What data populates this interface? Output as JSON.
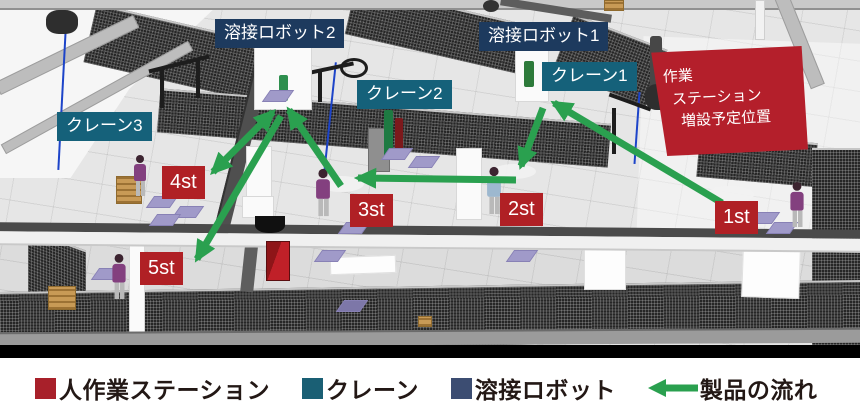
{
  "figure": {
    "title_hint": "3D factory layout simulation with product flow",
    "annotations": {
      "welding_robot_2": "溶接ロボット2",
      "welding_robot_1": "溶接ロボット1",
      "crane_1": "クレーン1",
      "crane_2": "クレーン2",
      "crane_3": "クレーン3",
      "planned_station_line1": "作業",
      "planned_station_line2": "ステーション",
      "planned_station_line3": "増設予定位置",
      "station_1": "1st",
      "station_2": "2st",
      "station_3": "3st",
      "station_4": "4st",
      "station_5": "5st"
    },
    "colors": {
      "welding_robot_label": "#1d3a5e",
      "crane_label": "#15617a",
      "station_label": "#b02025",
      "planned_station_box": "#b41f2b",
      "flow_arrow": "#2aa04f",
      "legend_text": "#231815"
    }
  },
  "legend": {
    "items": [
      {
        "label": "人作業ステーション",
        "swatch": "#a8202a",
        "icon": "square"
      },
      {
        "label": "クレーン",
        "swatch": "#1a5f74",
        "icon": "square"
      },
      {
        "label": "溶接ロボット",
        "swatch": "#3c4d72",
        "icon": "square"
      },
      {
        "label": "製品の流れ",
        "swatch": "#2aa04f",
        "icon": "left-arrow"
      }
    ]
  }
}
